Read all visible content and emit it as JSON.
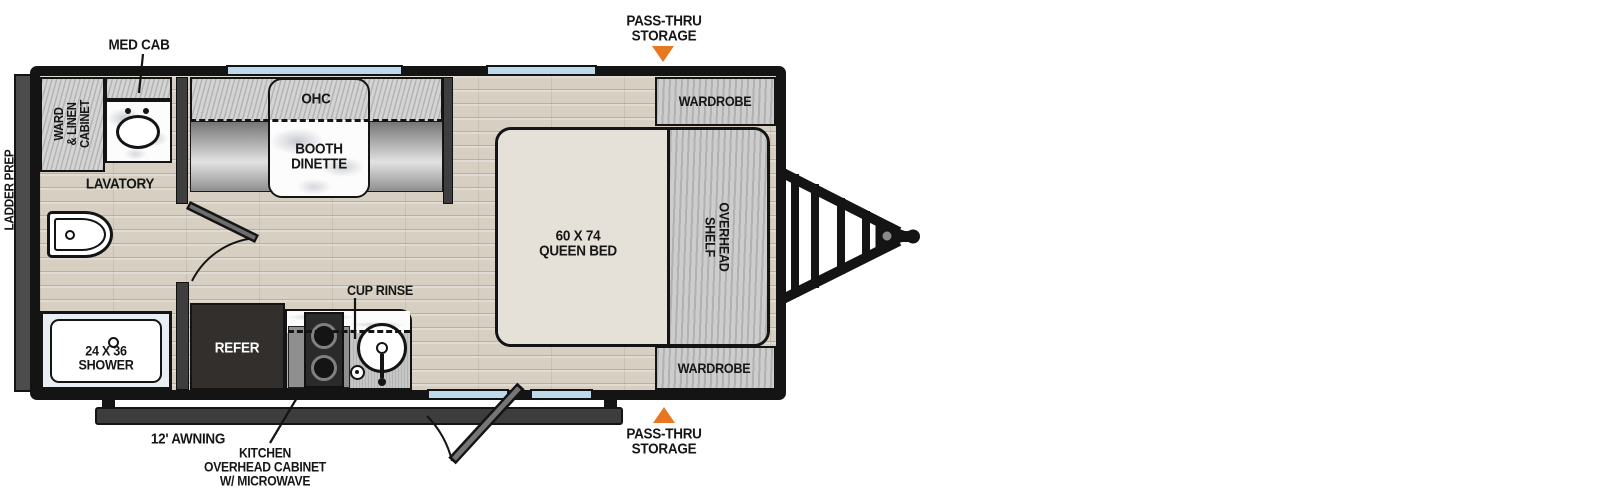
{
  "colors": {
    "arrow_orange": "#E87722",
    "window_blue": "#BDD9EC",
    "wall_black": "#141414",
    "floor_wood": "#D6CFC2",
    "mattress_cream": "#E5E1D8"
  },
  "exterior": {
    "med_cab": "MED CAB",
    "pass_thru_top": {
      "line1": "PASS-THRU",
      "line2": "STORAGE"
    },
    "pass_thru_bottom": {
      "line1": "PASS-THRU",
      "line2": "STORAGE"
    },
    "ladder_prep": "LADDER PREP",
    "awning": "12' AWNING",
    "kitchen_overhead": {
      "line1": "KITCHEN",
      "line2": "OVERHEAD CABINET",
      "line3": "W/ MICROWAVE"
    }
  },
  "bathroom": {
    "ward_linen_cabinet": {
      "line1": "WARD",
      "line2": "& LINEN",
      "line3": "CABINET"
    },
    "lavatory": "LAVATORY",
    "shower": {
      "line1": "24 X 36",
      "line2": "SHOWER"
    }
  },
  "dinette": {
    "ohc": "OHC",
    "booth": {
      "line1": "BOOTH",
      "line2": "DINETTE"
    }
  },
  "bedroom": {
    "wardrobe_top": "WARDROBE",
    "wardrobe_bottom": "WARDROBE",
    "queen_bed": {
      "line1": "60 X 74",
      "line2": "QUEEN BED"
    },
    "overhead_shelf": {
      "line1": "OVERHEAD",
      "line2": "SHELF"
    }
  },
  "kitchen": {
    "refer": "REFER",
    "cup_rinse": "CUP RINSE"
  }
}
